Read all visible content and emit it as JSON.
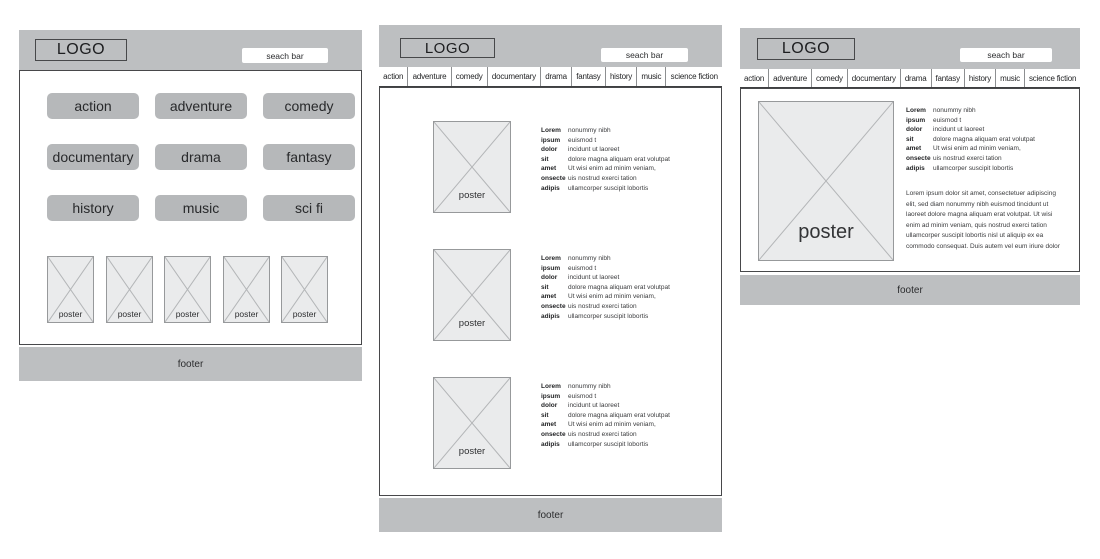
{
  "colors": {
    "bar_gray": "#bdbfc1",
    "button_gray": "#b6b8ba",
    "poster_fill": "#eaebec",
    "poster_border": "#97999b",
    "outline_dark": "#47484a",
    "search_bg": "#ffffff"
  },
  "chrome": {
    "logo": "LOGO",
    "search_placeholder": "seach bar",
    "footer_label": "footer"
  },
  "nav": {
    "items": [
      "action",
      "adventure",
      "comedy",
      "documentary",
      "drama",
      "fantasy",
      "history",
      "music",
      "science fiction"
    ]
  },
  "home_panel": {
    "category_buttons": [
      "action",
      "adventure",
      "comedy",
      "documentary",
      "drama",
      "fantasy",
      "history",
      "music",
      "sci fi"
    ],
    "posters": [
      "poster",
      "poster",
      "poster",
      "poster",
      "poster"
    ]
  },
  "list_panel": {
    "poster_label": "poster",
    "rows": [
      {
        "label": "Lorem",
        "value": "nonummy nibh"
      },
      {
        "label": "ipsum",
        "value": "euismod t"
      },
      {
        "label": "dolor",
        "value": "incidunt ut laoreet"
      },
      {
        "label": "sit",
        "value": "dolore magna aliquam erat volutpat"
      },
      {
        "label": "amet",
        "value": "Ut wisi enim ad minim veniam,"
      },
      {
        "label": "onsecte",
        "value": "uis nostrud exerci tation"
      },
      {
        "label": "adipis",
        "value": "ullamcorper suscipit lobortis"
      }
    ]
  },
  "detail_panel": {
    "poster_label": "poster",
    "rows": [
      {
        "label": "Lorem",
        "value": "nonummy nibh"
      },
      {
        "label": "ipsum",
        "value": "euismod t"
      },
      {
        "label": "dolor",
        "value": "incidunt ut laoreet"
      },
      {
        "label": "sit",
        "value": "dolore magna aliquam erat volutpat"
      },
      {
        "label": "amet",
        "value": "Ut wisi enim ad minim veniam,"
      },
      {
        "label": "onsecte",
        "value": "uis nostrud exerci tation"
      },
      {
        "label": "adipis",
        "value": "ullamcorper suscipit lobortis"
      }
    ],
    "paragraph": "Lorem ipsum dolor sit amet, consectetuer adipiscing elit, sed diam nonummy nibh euismod tincidunt ut laoreet dolore magna aliquam erat volutpat. Ut wisi enim ad minim veniam, quis nostrud exerci tation ullamcorper suscipit lobortis nisl ut aliquip ex ea commodo consequat. Duis autem vel eum iriure dolor"
  }
}
